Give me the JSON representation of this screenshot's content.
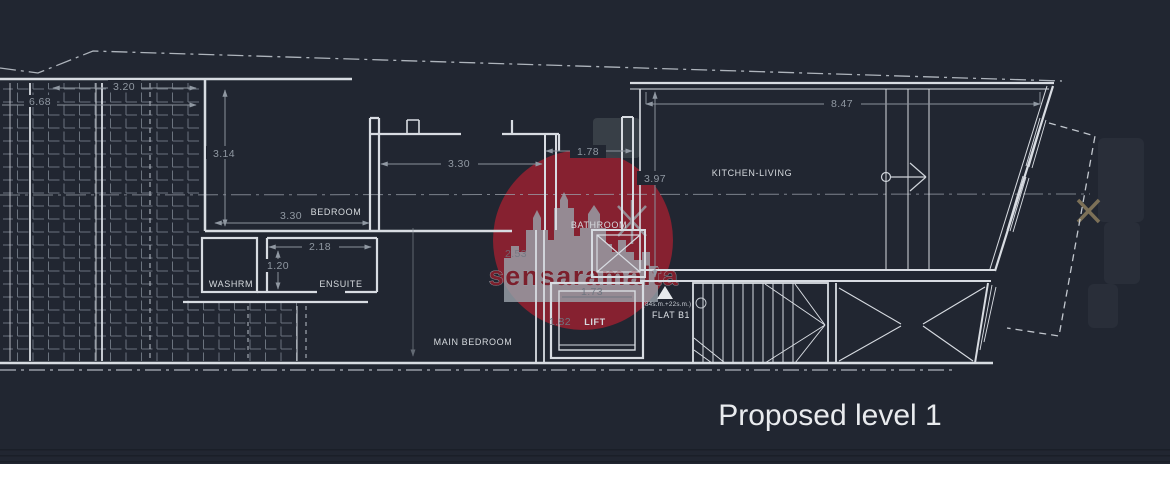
{
  "title": "Proposed level 1",
  "watermark": {
    "text": "sensaramalta",
    "circle_color": "#8a2130",
    "text_color": "#7c1f2c"
  },
  "rooms": {
    "bedroom": "BEDROOM",
    "washroom": "WASHRM",
    "ensuite": "ENSUITE",
    "bathroom": "BATHROOM",
    "lift": "LIFT",
    "main_bedroom": "MAIN BEDROOM",
    "kitchen_living": "KITCHEN-LIVING"
  },
  "flat": {
    "label": "FLAT B1",
    "area_note": "(84s.m.+22s.m.)"
  },
  "dimensions": {
    "roof_width": "3.20",
    "site_width": "6.68",
    "bedroom_depth": "3.14",
    "bedroom_width": "3.30",
    "hall_width": "3.30",
    "ensuite_width": "2.18",
    "ensuite_depth": "1.20",
    "bathroom_width": "1.78",
    "bathroom_depth": "2.53",
    "kitchen_depth": "3.97",
    "kitchen_width": "8.47",
    "lift_width": "1.73",
    "lift_depth": "1.82"
  },
  "colors": {
    "background": "#212631",
    "wall_line": "#d8dce2",
    "dimension_text": "#9098a2"
  }
}
